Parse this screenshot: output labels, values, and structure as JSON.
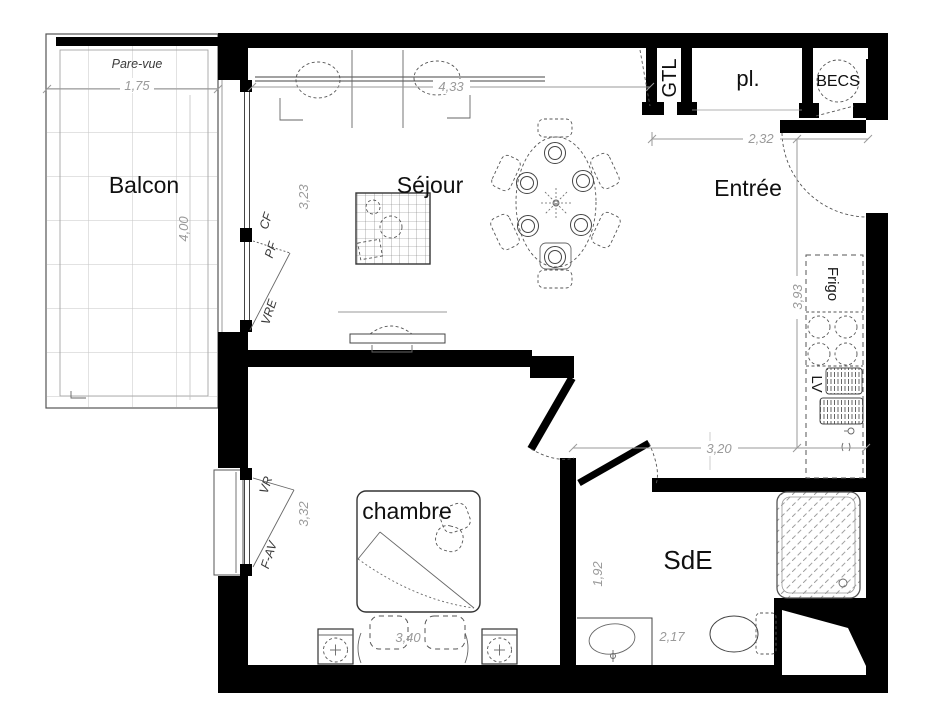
{
  "rooms": {
    "balcony": "Balcon",
    "living_room": "Séjour",
    "entry": "Entrée",
    "bedroom": "chambre",
    "shower_room": "SdE"
  },
  "closets": {
    "technical": "GTL",
    "wardrobe": "pl.",
    "water_heater": "BECS"
  },
  "appliances": {
    "fridge": "Frigo",
    "dishwasher": "LV"
  },
  "window_annotations": {
    "privacy_screen": "Pare-vue",
    "fixed_frame": "CF",
    "french_window": "PF",
    "roller_shutter_elec": "VRE",
    "roller_shutter": "VR",
    "awning_window": "F-AV"
  },
  "dimensions": {
    "balcony_depth": "1,75",
    "balcony_length": "4,00",
    "living_width": "4,33",
    "living_depth": "3,23",
    "entry_width": "2,32",
    "kitchen_run": "3,93",
    "corridor_width": "3,20",
    "bedroom_depth": "3,32",
    "bedroom_width": "3,40",
    "shower_room_depth": "1,92",
    "shower_room_width": "2,17"
  },
  "colors": {
    "walls": "#000000",
    "furniture_lines": "#444444",
    "dimensions": "#9a9a9a",
    "tile_grid": "#c6c6c6",
    "background": "#ffffff"
  }
}
